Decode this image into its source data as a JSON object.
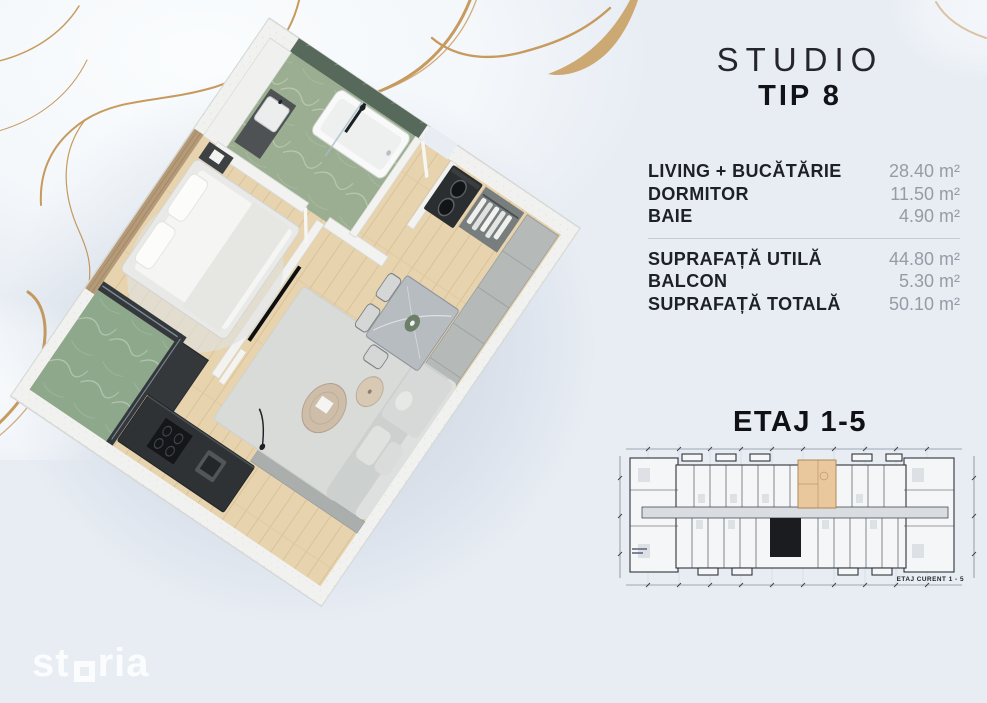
{
  "header": {
    "title": "STUDIO",
    "subtitle": "TIP 8"
  },
  "areas": {
    "rooms": [
      {
        "label": "LIVING + BUCĂTĂRIE",
        "value": "28.40 m²"
      },
      {
        "label": "DORMITOR",
        "value": "11.50 m²"
      },
      {
        "label": "BAIE",
        "value": "4.90 m²"
      }
    ],
    "totals": [
      {
        "label": "SUPRAFAȚĂ UTILĂ",
        "value": "44.80 m²"
      },
      {
        "label": "BALCON",
        "value": "5.30 m²"
      },
      {
        "label": "SUPRAFAȚĂ TOTALĂ",
        "value": "50.10 m²"
      }
    ]
  },
  "floor_section": {
    "heading": "ETAJ 1-5",
    "plan_caption": "ETAJ CURENT 1 - 5"
  },
  "watermark": {
    "brand": "storia",
    "part1": "st",
    "part2": "ria"
  },
  "colors": {
    "background": "#e8edf4",
    "accent_gold": "#c79a5e",
    "text_primary": "#1d2026",
    "text_secondary": "#959ca6",
    "unit_highlight": "#eac89e",
    "core_black": "#1a1c1f",
    "marble_green": "#5d7060",
    "wood_floor": "#e7d3ae"
  }
}
